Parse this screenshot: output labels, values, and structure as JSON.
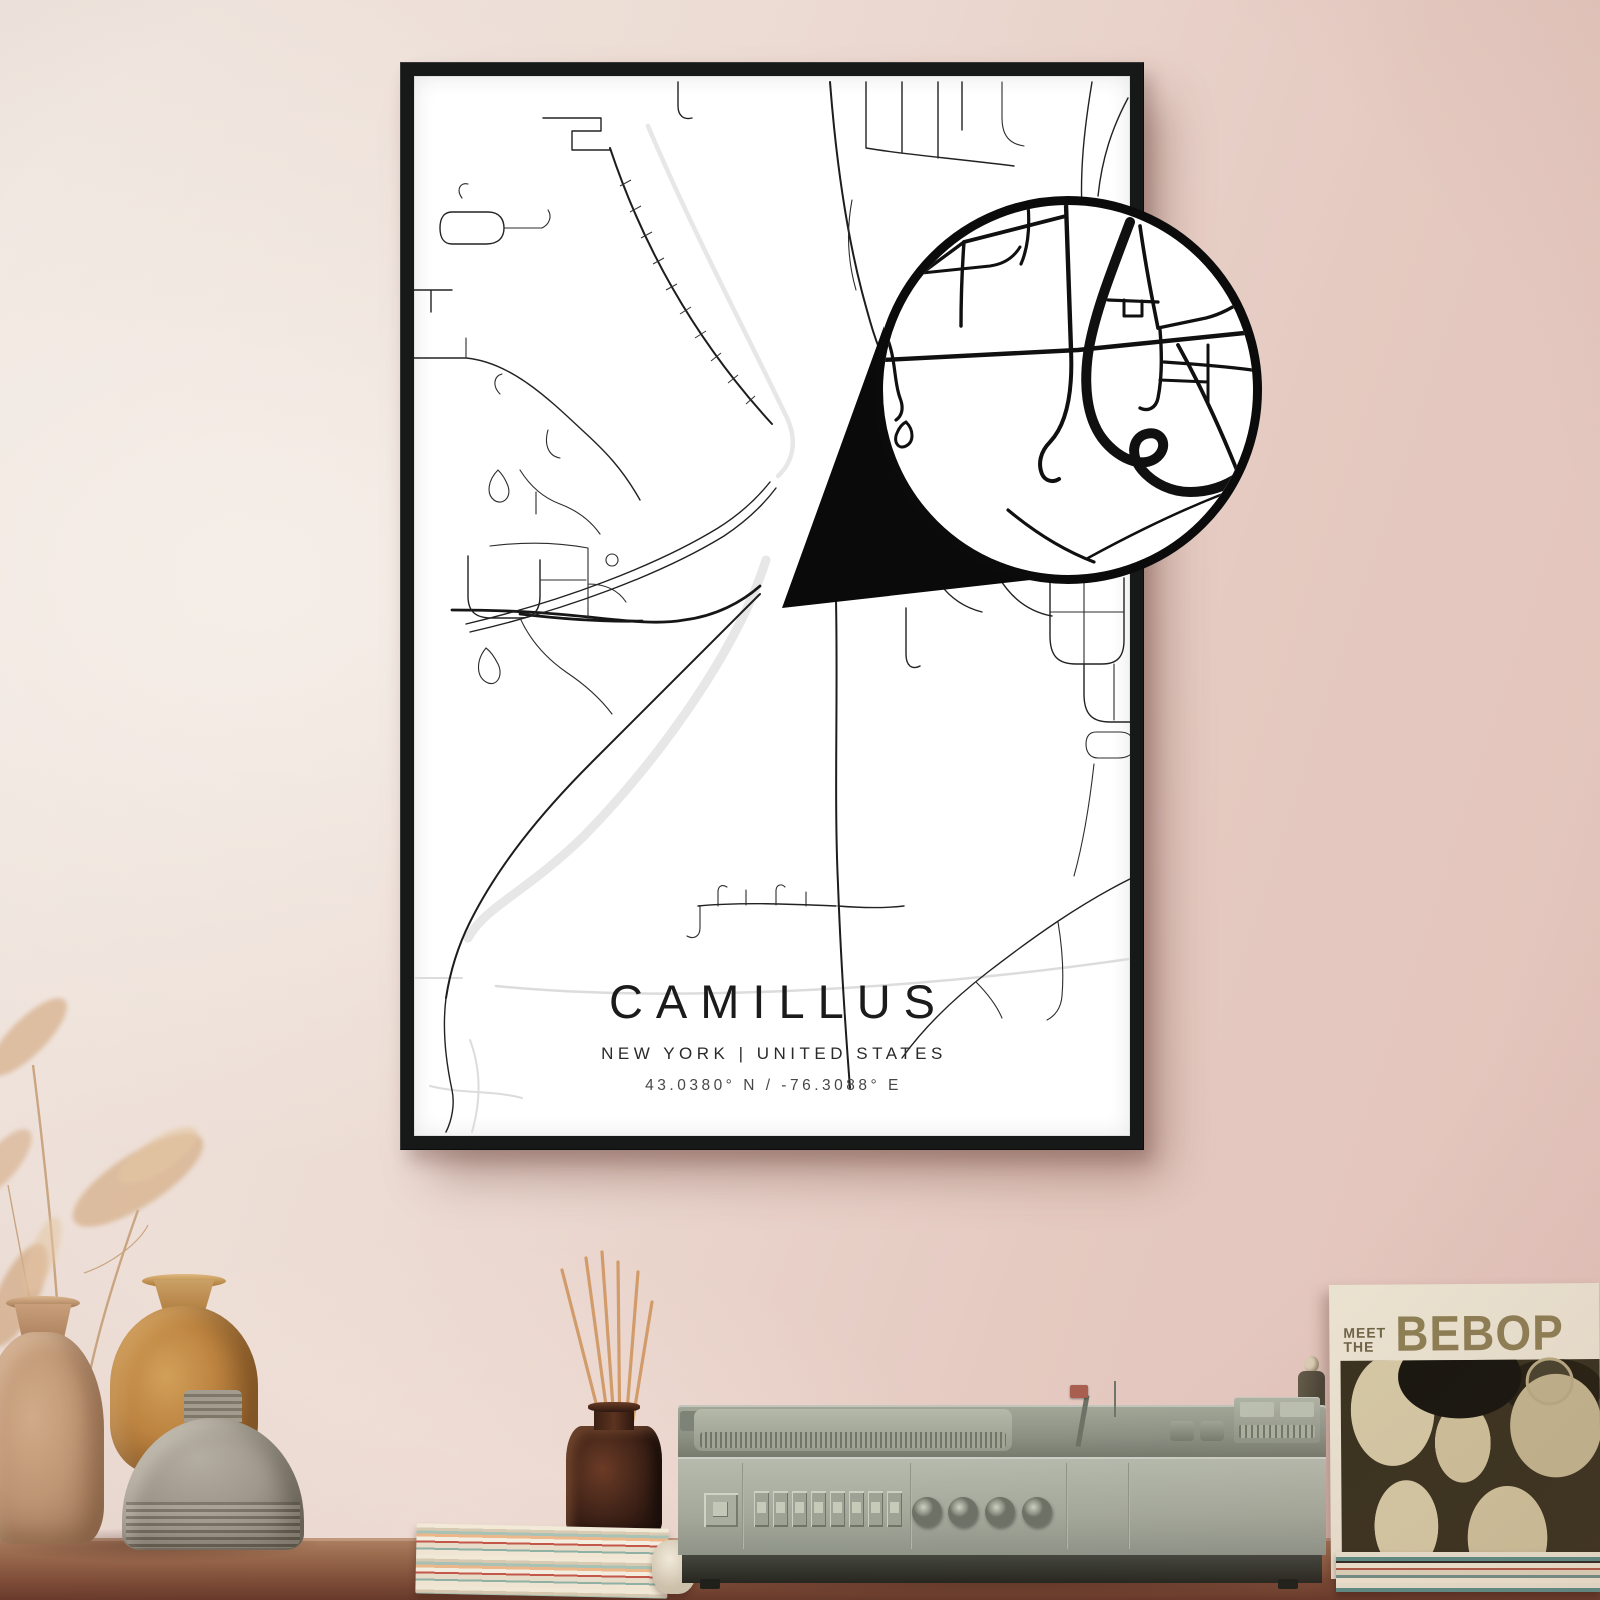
{
  "poster": {
    "title": "CAMILLUS",
    "subtitle": "NEW YORK | UNITED STATES",
    "coordinates": "43.0380° N / -76.3088° E",
    "frame_color": "#171918",
    "paper_color": "#ffffff",
    "road_color": "#1e1e1e",
    "water_color": "#e7e7e7"
  },
  "magnifier": {
    "border_color": "#0b0b0b",
    "fill_color": "#ffffff"
  },
  "decor": {
    "album": {
      "title_line1": "MEET",
      "title_line2": "THE",
      "title_line3": "BEBOP",
      "cover_background": "#39321f",
      "title_color": "#8e7f55"
    }
  },
  "scene_colors": {
    "wall_left": "#efe6df",
    "wall_right": "#e2c2ba",
    "shelf": "#7d4c37"
  }
}
